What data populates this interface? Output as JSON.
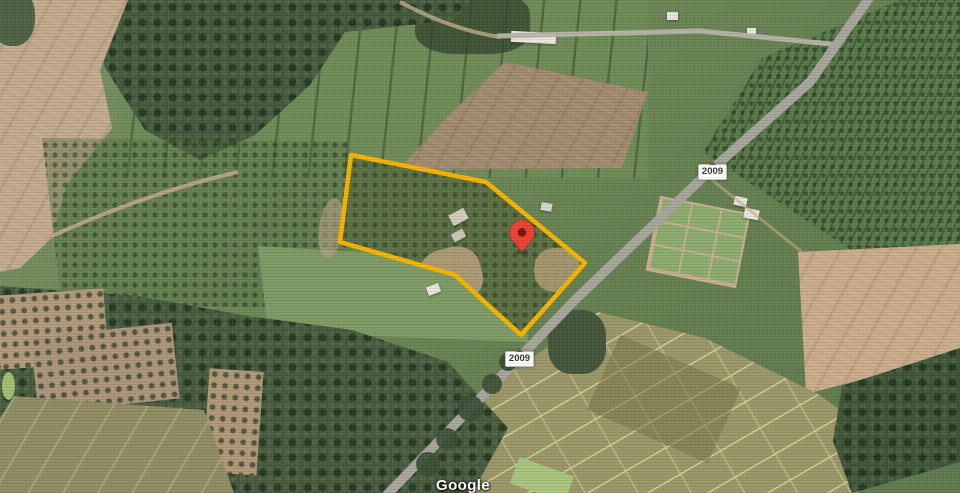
{
  "map": {
    "attribution_logo": "Google",
    "route_shields": [
      {
        "label": "2009"
      },
      {
        "label": "2009"
      }
    ],
    "parcel": {
      "outline_color": "#F4B400"
    },
    "marker": {
      "fill": "#EA4335",
      "dot_color": "#7E120B"
    }
  }
}
